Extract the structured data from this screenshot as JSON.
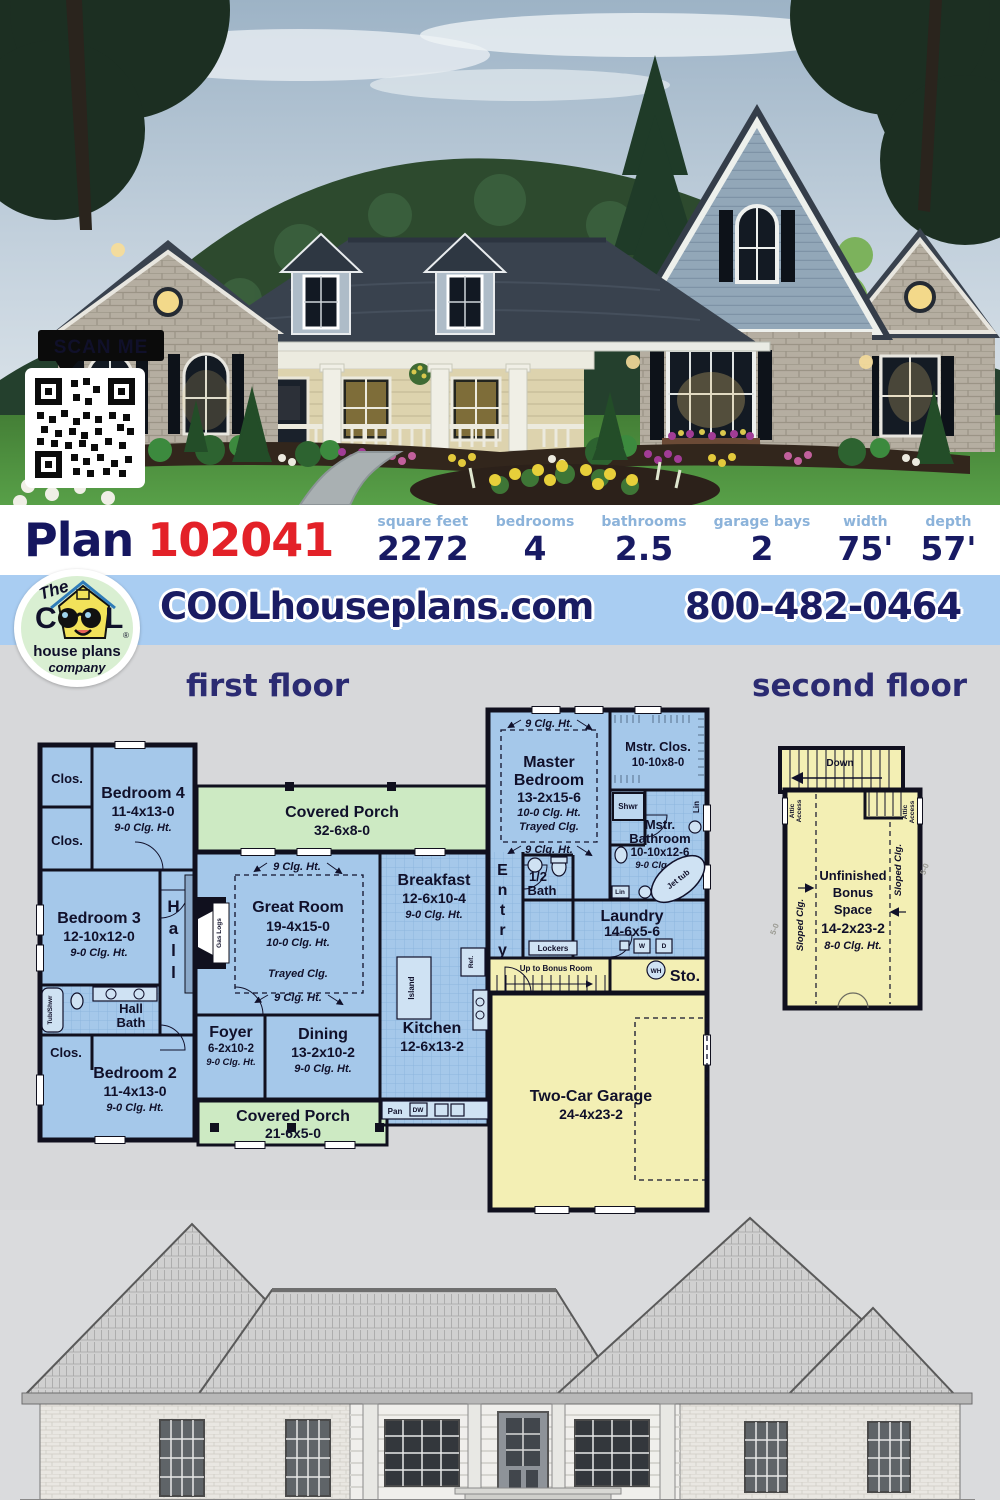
{
  "photo": {
    "scan_me": "SCAN ME"
  },
  "plan_bar": {
    "plan_word": "Plan",
    "plan_number": "102041",
    "stats": [
      {
        "label": "square feet",
        "value": "2272"
      },
      {
        "label": "bedrooms",
        "value": "4"
      },
      {
        "label": "bathrooms",
        "value": "2.5"
      },
      {
        "label": "garage bays",
        "value": "2"
      },
      {
        "label": "width",
        "value": "75'"
      },
      {
        "label": "depth",
        "value": "57'"
      }
    ]
  },
  "brand_bar": {
    "website": "COOLhouseplans.com",
    "phone": "800-482-0464",
    "logo": {
      "the": "The",
      "cool": "C",
      "cool_l": "L",
      "reg": "®",
      "house_plans": "house plans",
      "company": "company"
    }
  },
  "floors": {
    "first": "first floor",
    "second": "second floor"
  },
  "f1": {
    "clos": "Clos.",
    "bedroom4": [
      "Bedroom 4",
      "11-4x13-0",
      "9-0 Clg. Ht."
    ],
    "porch_top": [
      "Covered Porch",
      "32-6x8-0"
    ],
    "bedroom3": [
      "Bedroom 3",
      "12-10x12-0",
      "9-0 Clg. Ht."
    ],
    "hall": "Hall",
    "gas_logs": "Gas Logs",
    "great_room": [
      "Great Room",
      "19-4x15-0",
      "10-0 Clg. Ht."
    ],
    "trayed": "Trayed Clg.",
    "clg9": "9 Clg. Ht.",
    "breakfast": [
      "Breakfast",
      "12-6x10-4",
      "9-0 Clg. Ht."
    ],
    "entry": "Entry",
    "master": [
      "Master",
      "Bedroom",
      "13-2x15-6",
      "10-0 Clg. Ht.",
      "Trayed Clg."
    ],
    "mstr_clos": [
      "Mstr. Clos.",
      "10-10x8-0"
    ],
    "shwr": "Shwr",
    "lin": "Lin",
    "mstr_bath": [
      "Mstr.",
      "Bathroom",
      "10-10x12-6",
      "9-0 Clg. Ht."
    ],
    "jet_tub": "Jet tub",
    "half_bath": [
      "1/2",
      "Bath"
    ],
    "laundry": [
      "Laundry",
      "14-6x5-6"
    ],
    "w": "W",
    "d": "D",
    "lockers": "Lockers",
    "up_to_bonus": "Up to Bonus Room",
    "wh": "WH",
    "sto": "Sto.",
    "garage": [
      "Two-Car Garage",
      "24-4x23-2"
    ],
    "foyer": [
      "Foyer",
      "6-2x10-2",
      "9-0 Clg. Ht."
    ],
    "dining": [
      "Dining",
      "13-2x10-2",
      "9-0 Clg. Ht."
    ],
    "kitchen": [
      "Kitchen",
      "12-6x13-2"
    ],
    "pan": "Pan",
    "dw": "DW",
    "island": "Island",
    "ref": "Ref.",
    "porch_bottom": [
      "Covered Porch",
      "21-6x5-0"
    ],
    "hall_bath": [
      "Hall",
      "Bath"
    ],
    "tub_shwr": "Tub/Shwr",
    "bedroom2": [
      "Bedroom 2",
      "11-4x13-0",
      "9-0 Clg. Ht."
    ]
  },
  "f2": {
    "down": "Down",
    "attic": [
      "Attic",
      "Access"
    ],
    "sloped": "Sloped Clg.",
    "bonus": [
      "Unfinished",
      "Bonus",
      "Space",
      "14-2x23-2",
      "8-0 Clg. Ht."
    ],
    "dim": "5-0"
  }
}
